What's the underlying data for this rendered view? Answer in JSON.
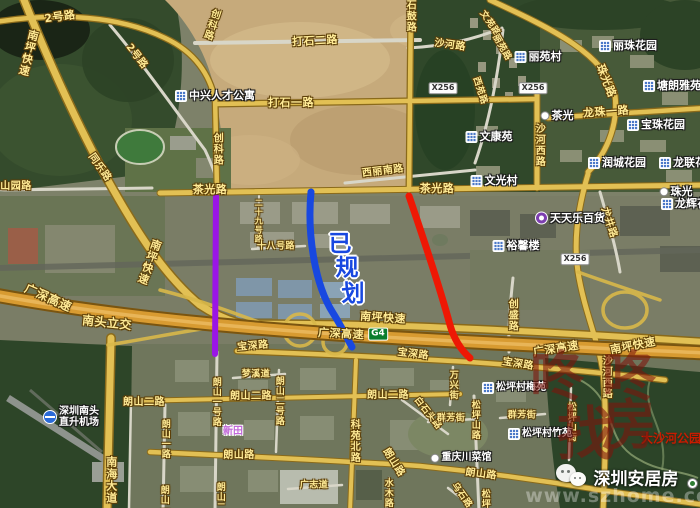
{
  "overlay": {
    "planned_text": {
      "color": "#1848e0",
      "size": 23,
      "chars": [
        {
          "ch": "已",
          "x": 340,
          "y": 241
        },
        {
          "ch": "规",
          "x": 347,
          "y": 265
        },
        {
          "ch": "划",
          "x": 353,
          "y": 291
        }
      ]
    },
    "lines": [
      {
        "name": "purple-planned-line",
        "color": "#9a16e6"
      },
      {
        "name": "blue-planned-line",
        "color": "#1848e0"
      },
      {
        "name": "red-planned-line",
        "color": "#ee1804"
      }
    ]
  },
  "labels": {
    "roads": [
      {
        "text": "2号路",
        "x": 60,
        "y": 17,
        "rot": -8,
        "size": 11
      },
      {
        "text": "南坪快速",
        "x": 28,
        "y": 53,
        "orient": "v",
        "rot": 14,
        "size": 11
      },
      {
        "text": "2号路",
        "x": 136,
        "y": 57,
        "rot": 52,
        "size": 10
      },
      {
        "text": "创科路",
        "x": 210,
        "y": 24,
        "orient": "v",
        "rot": 18,
        "size": 10
      },
      {
        "text": "打石二路",
        "x": 315,
        "y": 41,
        "rot": -3,
        "size": 11
      },
      {
        "text": "沙河路",
        "x": 450,
        "y": 46,
        "rot": 8,
        "size": 10
      },
      {
        "text": "石鼓路",
        "x": 409,
        "y": 16,
        "orient": "v",
        "size": 10
      },
      {
        "text": "文苑路",
        "x": 489,
        "y": 24,
        "rot": 55,
        "size": 9
      },
      {
        "text": "丽苑路",
        "x": 501,
        "y": 48,
        "rot": 60,
        "size": 9
      },
      {
        "text": "西苑路",
        "x": 479,
        "y": 91,
        "rot": 72,
        "size": 9
      },
      {
        "text": "打石一路",
        "x": 291,
        "y": 103,
        "size": 11
      },
      {
        "text": "创科路",
        "x": 216,
        "y": 149,
        "orient": "v",
        "size": 10
      },
      {
        "text": "珠光路",
        "x": 606,
        "y": 81,
        "rot": 68,
        "size": 11
      },
      {
        "text": "龙珠一路",
        "x": 606,
        "y": 112,
        "rot": -4,
        "size": 11
      },
      {
        "text": "沙河西路",
        "x": 538,
        "y": 145,
        "orient": "v",
        "size": 10
      },
      {
        "text": "山园路",
        "x": 16,
        "y": 187,
        "size": 10
      },
      {
        "text": "同乐路",
        "x": 99,
        "y": 168,
        "rot": 55,
        "size": 10
      },
      {
        "text": "茶光路",
        "x": 210,
        "y": 190,
        "size": 11
      },
      {
        "text": "西丽南路",
        "x": 383,
        "y": 172,
        "rot": -7,
        "size": 10
      },
      {
        "text": "茶光路",
        "x": 437,
        "y": 189,
        "size": 11
      },
      {
        "text": "二十九号路",
        "x": 258,
        "y": 221,
        "orient": "v",
        "size": 8
      },
      {
        "text": "十八号路",
        "x": 276,
        "y": 247,
        "size": 9
      },
      {
        "text": "龙井路",
        "x": 608,
        "y": 223,
        "rot": 72,
        "size": 10
      },
      {
        "text": "南坪快速",
        "x": 149,
        "y": 262,
        "orient": "v",
        "rot": 20,
        "size": 11
      },
      {
        "text": "广深高速",
        "x": 48,
        "y": 298,
        "rot": 24,
        "size": 12
      },
      {
        "text": "南头立交",
        "x": 107,
        "y": 323,
        "rot": 6,
        "size": 12
      },
      {
        "text": "创盛路",
        "x": 511,
        "y": 315,
        "orient": "v",
        "size": 10
      },
      {
        "text": "南坪快速",
        "x": 383,
        "y": 318,
        "rot": 4,
        "size": 11
      },
      {
        "text": "广深高速",
        "x": 341,
        "y": 334,
        "rot": 3,
        "size": 11
      },
      {
        "text": "广深高速",
        "x": 556,
        "y": 349,
        "rot": -9,
        "size": 11
      },
      {
        "text": "南坪快速",
        "x": 633,
        "y": 346,
        "rot": -11,
        "size": 11
      },
      {
        "text": "宝深路",
        "x": 253,
        "y": 347,
        "rot": -5,
        "size": 10
      },
      {
        "text": "宝深路",
        "x": 413,
        "y": 355,
        "rot": 7,
        "size": 10
      },
      {
        "text": "宝深路",
        "x": 518,
        "y": 365,
        "rot": 9,
        "size": 10
      },
      {
        "text": "梦溪道",
        "x": 256,
        "y": 375,
        "size": 9
      },
      {
        "text": "朗山二路",
        "x": 144,
        "y": 403,
        "size": 10
      },
      {
        "text": "朗山二路",
        "x": 251,
        "y": 397,
        "size": 10
      },
      {
        "text": "朗山二号路",
        "x": 278,
        "y": 401,
        "orient": "v",
        "size": 9
      },
      {
        "text": "朗山二路",
        "x": 388,
        "y": 396,
        "size": 10
      },
      {
        "text": "万兴街",
        "x": 452,
        "y": 385,
        "orient": "v",
        "size": 9
      },
      {
        "text": "白石头路",
        "x": 427,
        "y": 414,
        "rot": 52,
        "size": 9
      },
      {
        "text": "群芳街",
        "x": 451,
        "y": 419,
        "size": 9
      },
      {
        "text": "群芳街",
        "x": 522,
        "y": 416,
        "size": 9
      },
      {
        "text": "松坪山路",
        "x": 474,
        "y": 420,
        "orient": "v",
        "size": 9
      },
      {
        "text": "松坪山街",
        "x": 570,
        "y": 422,
        "orient": "v",
        "size": 9
      },
      {
        "text": "沙河西路",
        "x": 605,
        "y": 377,
        "orient": "v",
        "size": 10
      },
      {
        "text": "科苑北路",
        "x": 353,
        "y": 441,
        "orient": "v",
        "size": 10
      },
      {
        "text": "朗山一路",
        "x": 164,
        "y": 439,
        "orient": "v",
        "size": 9
      },
      {
        "text": "朗山一号路",
        "x": 215,
        "y": 402,
        "orient": "v",
        "size": 9
      },
      {
        "text": "朗山路",
        "x": 239,
        "y": 456,
        "size": 10
      },
      {
        "text": "朗山路",
        "x": 393,
        "y": 463,
        "rot": 58,
        "size": 10
      },
      {
        "text": "朗山路",
        "x": 481,
        "y": 475,
        "rot": 7,
        "size": 10
      },
      {
        "text": "南海大道",
        "x": 111,
        "y": 480,
        "orient": "v",
        "size": 11
      },
      {
        "text": "朗山一路",
        "x": 163,
        "y": 505,
        "orient": "v",
        "size": 9
      },
      {
        "text": "朗山二号路",
        "x": 219,
        "y": 507,
        "orient": "v",
        "size": 9
      },
      {
        "text": "水木路",
        "x": 387,
        "y": 493,
        "orient": "v",
        "size": 9
      },
      {
        "text": "广志道",
        "x": 314,
        "y": 486,
        "size": 9
      },
      {
        "text": "乌石路",
        "x": 461,
        "y": 496,
        "rot": 55,
        "size": 9
      },
      {
        "text": "松坪",
        "x": 484,
        "y": 499,
        "orient": "v",
        "size": 9
      }
    ],
    "badges": [
      {
        "text": "X256",
        "x": 443,
        "y": 88
      },
      {
        "text": "X256",
        "x": 533,
        "y": 88
      },
      {
        "text": "X256",
        "x": 575,
        "y": 259
      },
      {
        "text": "G4",
        "x": 378,
        "y": 334,
        "green": true
      }
    ],
    "places": [
      {
        "text": "中兴人才公寓",
        "x": 215,
        "y": 96,
        "icon": "building",
        "size": 11
      },
      {
        "text": "丽苑村",
        "x": 538,
        "y": 57,
        "icon": "building",
        "size": 11
      },
      {
        "text": "丽珠花园",
        "x": 628,
        "y": 46,
        "icon": "building",
        "size": 11
      },
      {
        "text": "塘朗雅苑",
        "x": 672,
        "y": 86,
        "icon": "building",
        "size": 11
      },
      {
        "text": "宝珠花园",
        "x": 656,
        "y": 125,
        "icon": "building",
        "size": 11
      },
      {
        "text": "润城花园",
        "x": 617,
        "y": 163,
        "icon": "building",
        "size": 11
      },
      {
        "text": "龙联花园",
        "x": 688,
        "y": 163,
        "icon": "building",
        "size": 11
      },
      {
        "text": "文康苑",
        "x": 489,
        "y": 137,
        "icon": "building",
        "size": 11
      },
      {
        "text": "文光村",
        "x": 494,
        "y": 181,
        "icon": "building",
        "size": 11
      },
      {
        "text": "茶光",
        "x": 557,
        "y": 116,
        "icon": "dot",
        "size": 11
      },
      {
        "text": "珠光",
        "x": 676,
        "y": 192,
        "icon": "dot",
        "size": 11
      },
      {
        "text": "龙辉花园",
        "x": 690,
        "y": 204,
        "icon": "building",
        "size": 11
      },
      {
        "text": "天天乐百货",
        "x": 570,
        "y": 218,
        "icon": "store",
        "size": 11
      },
      {
        "text": "裕馨楼",
        "x": 516,
        "y": 246,
        "icon": "building",
        "size": 11
      },
      {
        "lines": [
          "深圳南头",
          "直升机场"
        ],
        "x": 71,
        "y": 417,
        "icon": "heli",
        "size": 10
      },
      {
        "text": "松坪村梅苑",
        "x": 514,
        "y": 388,
        "icon": "building",
        "size": 10
      },
      {
        "text": "松坪村竹苑",
        "x": 540,
        "y": 434,
        "icon": "building",
        "size": 10
      },
      {
        "text": "重庆川菜馆",
        "x": 461,
        "y": 458,
        "icon": "dot",
        "size": 10
      },
      {
        "text": "新田",
        "x": 233,
        "y": 432,
        "style": "purple",
        "size": 10
      },
      {
        "text": "大沙河公园",
        "x": 671,
        "y": 439,
        "style": "park",
        "size": 12
      }
    ]
  },
  "watermark": {
    "brand": {
      "color": "#7e150c",
      "opacity": 0.58,
      "chars": [
        {
          "ch": "咚",
          "x": 557,
          "y": 372,
          "s": 54
        },
        {
          "ch": "咚",
          "x": 629,
          "y": 372,
          "s": 54
        },
        {
          "ch": "找",
          "x": 586,
          "y": 429,
          "s": 58
        },
        {
          "ch": "房",
          "x": 629,
          "y": 420,
          "s": 54
        }
      ]
    },
    "account": "深圳安居房",
    "url": "www.szhome.com"
  }
}
